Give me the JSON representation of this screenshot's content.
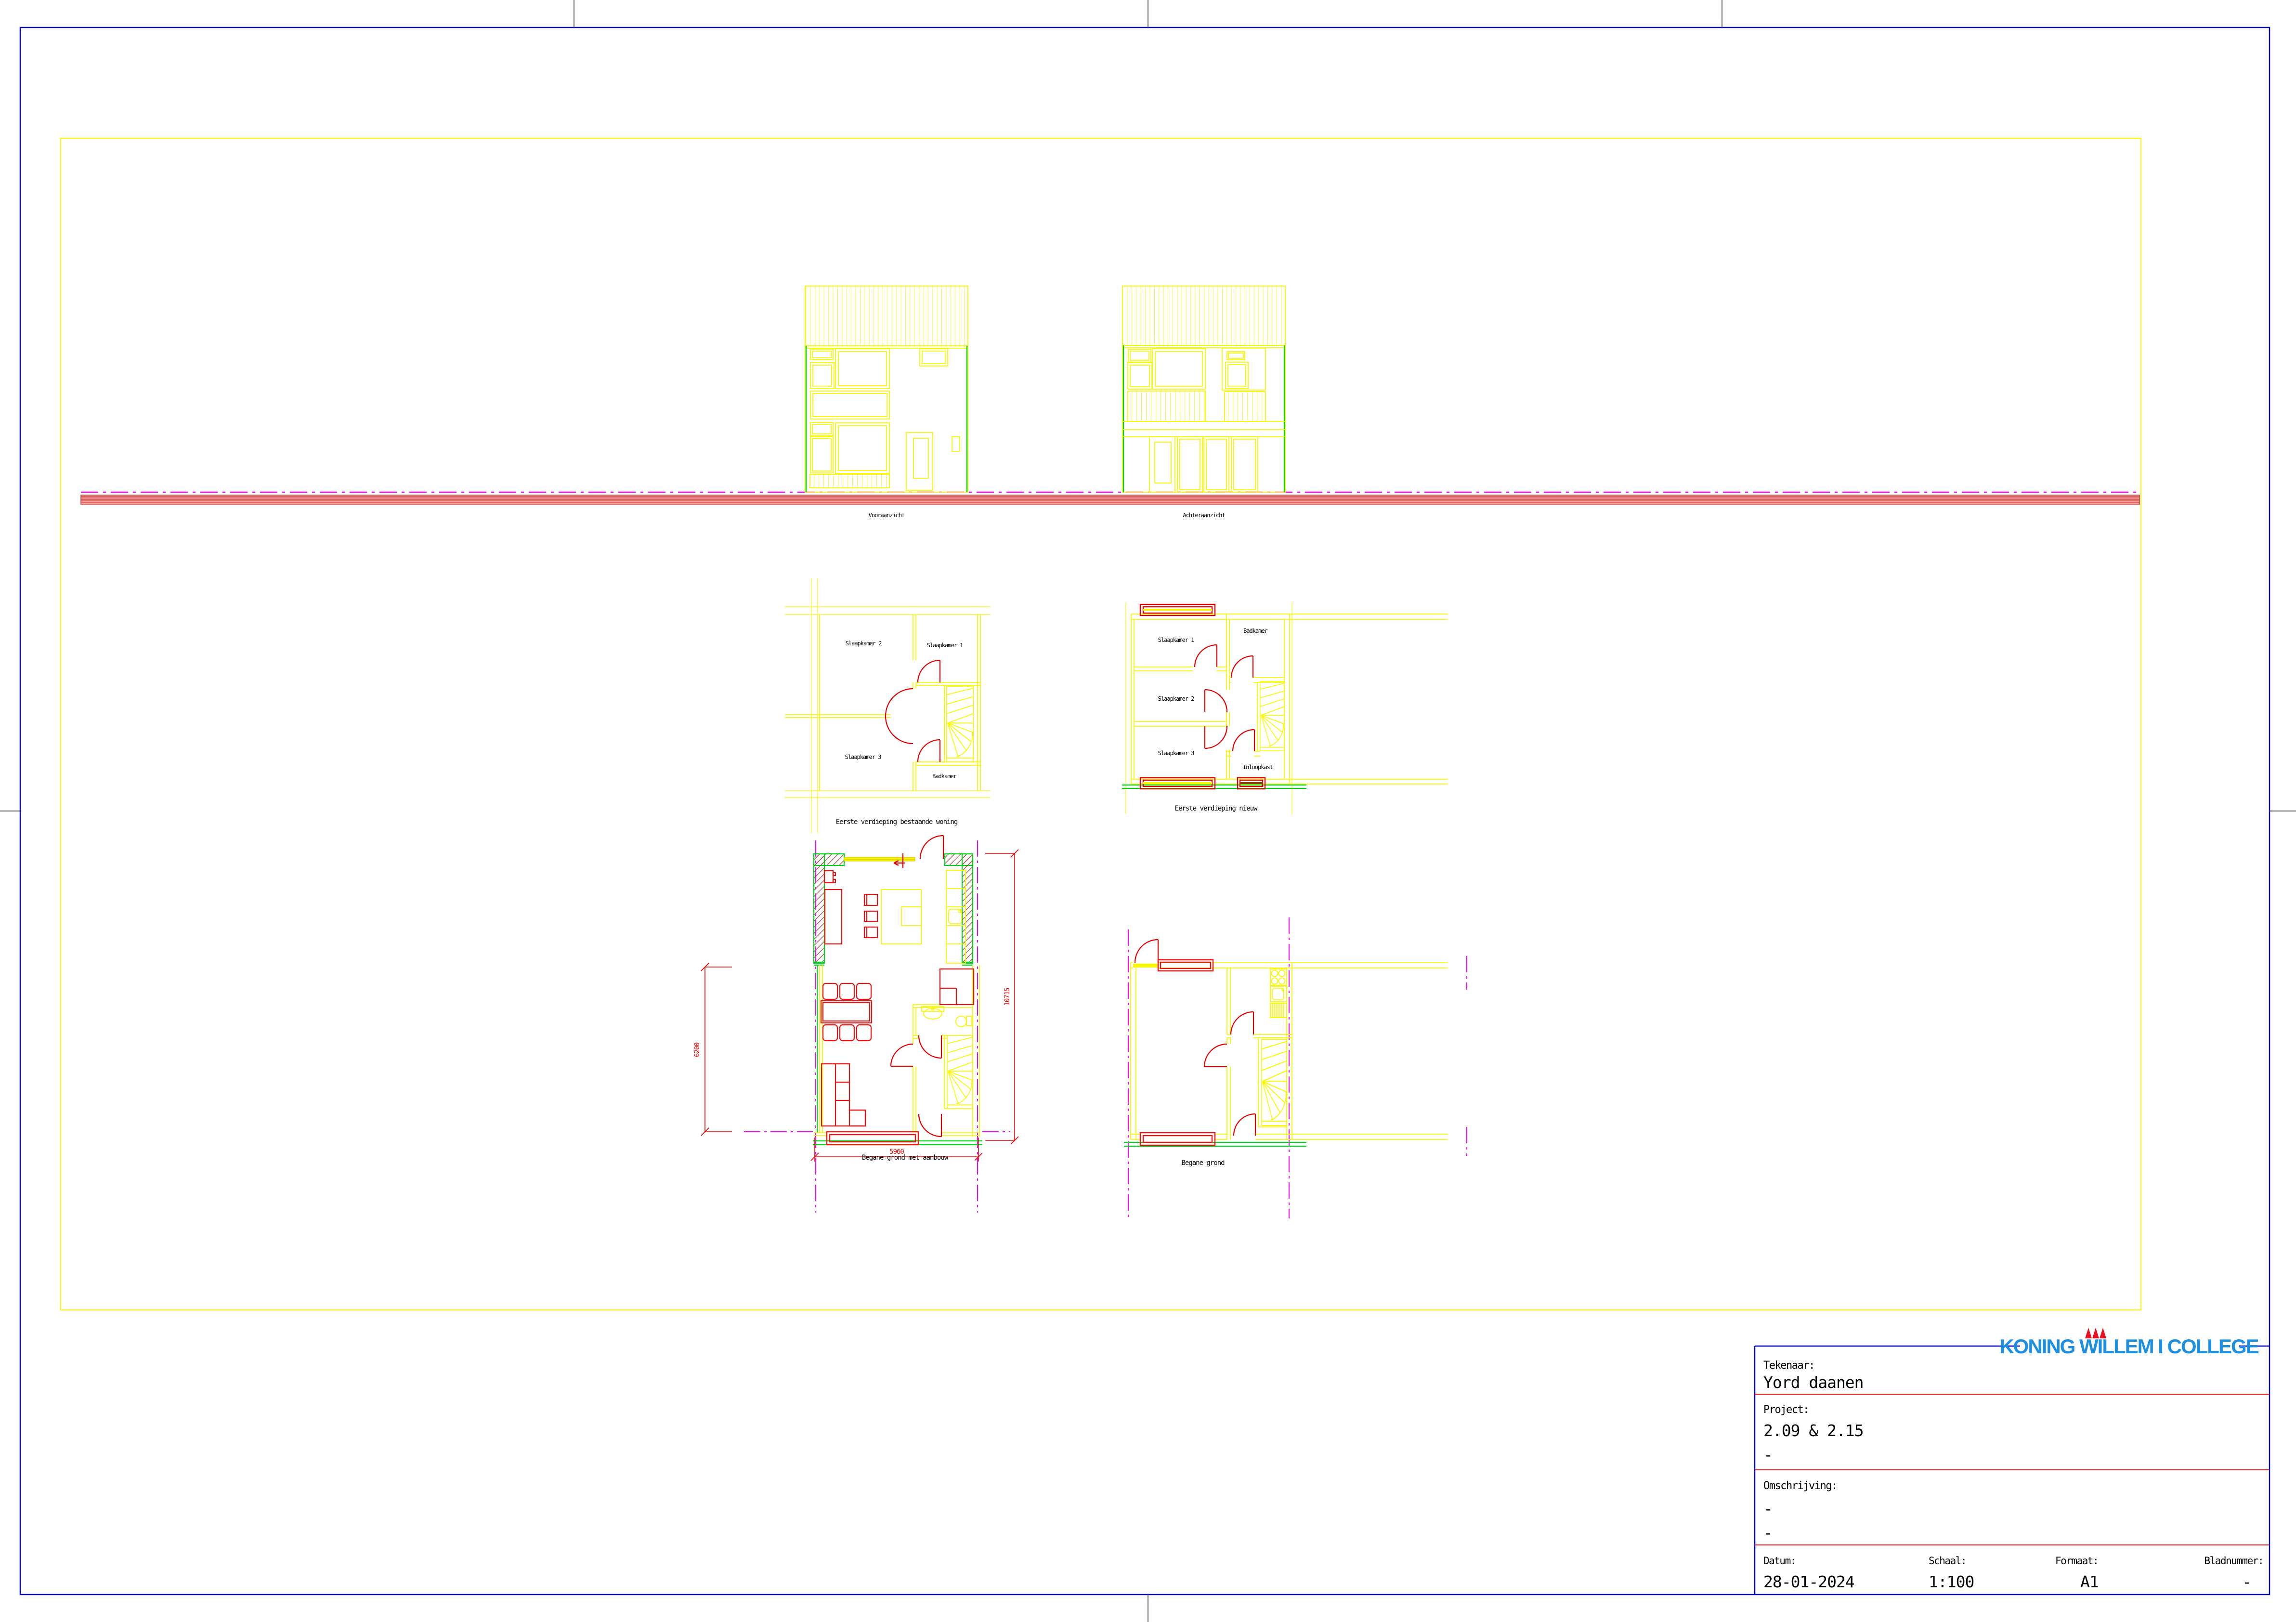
{
  "elevations": {
    "front_label": "Vooraanzicht",
    "rear_label": "Achteraanzicht"
  },
  "plans": {
    "first_existing": {
      "caption": "Eerste verdieping bestaande woning",
      "rooms": {
        "slaapkamer2": "Slaapkamer 2",
        "slaapkamer1": "Slaapkamer 1",
        "slaapkamer3": "Slaapkamer 3",
        "badkamer": "Badkamer"
      }
    },
    "first_new": {
      "caption": "Eerste verdieping nieuw",
      "rooms": {
        "slaapkamer1": "Slaapkamer 1",
        "badkamer": "Badkamer",
        "slaapkamer2": "Slaapkamer 2",
        "slaapkamer3": "Slaapkamer 3",
        "inloopkast": "Inloopkast"
      }
    },
    "ground_extension": {
      "caption": "Begane grond met aanbouw",
      "dimensions": {
        "depth_existing": "6200",
        "depth_total": "10715",
        "width": "5960"
      }
    },
    "ground": {
      "caption": "Begane grond"
    }
  },
  "title_block": {
    "logo": "KONING WILLEM I COLLEGE",
    "tekenaar_label": "Tekenaar:",
    "tekenaar": "Yord daanen",
    "project_label": "Project:",
    "project": "2.09 & 2.15",
    "project_note": "-",
    "omschrijving_label": "Omschrijving:",
    "omschrijving_1": "-",
    "omschrijving_2": "-",
    "datum_label": "Datum:",
    "datum": "28-01-2024",
    "schaal_label": "Schaal:",
    "schaal": "1:100",
    "formaat_label": "Formaat:",
    "formaat": "A1",
    "bladnummer_label": "Bladnummer:",
    "bladnummer": "-"
  },
  "colors": {
    "drawing_yellow": "#f8f800",
    "drawing_red": "#ee1111",
    "drawing_green": "#00d41e",
    "magenta": "#ff00ff",
    "border_blue": "#0000b4",
    "logo_blue": "#1d8fe1",
    "logo_red": "#e81123",
    "ground_band_fill": "#f2a19b",
    "brick_hatch": "#aa3333"
  }
}
